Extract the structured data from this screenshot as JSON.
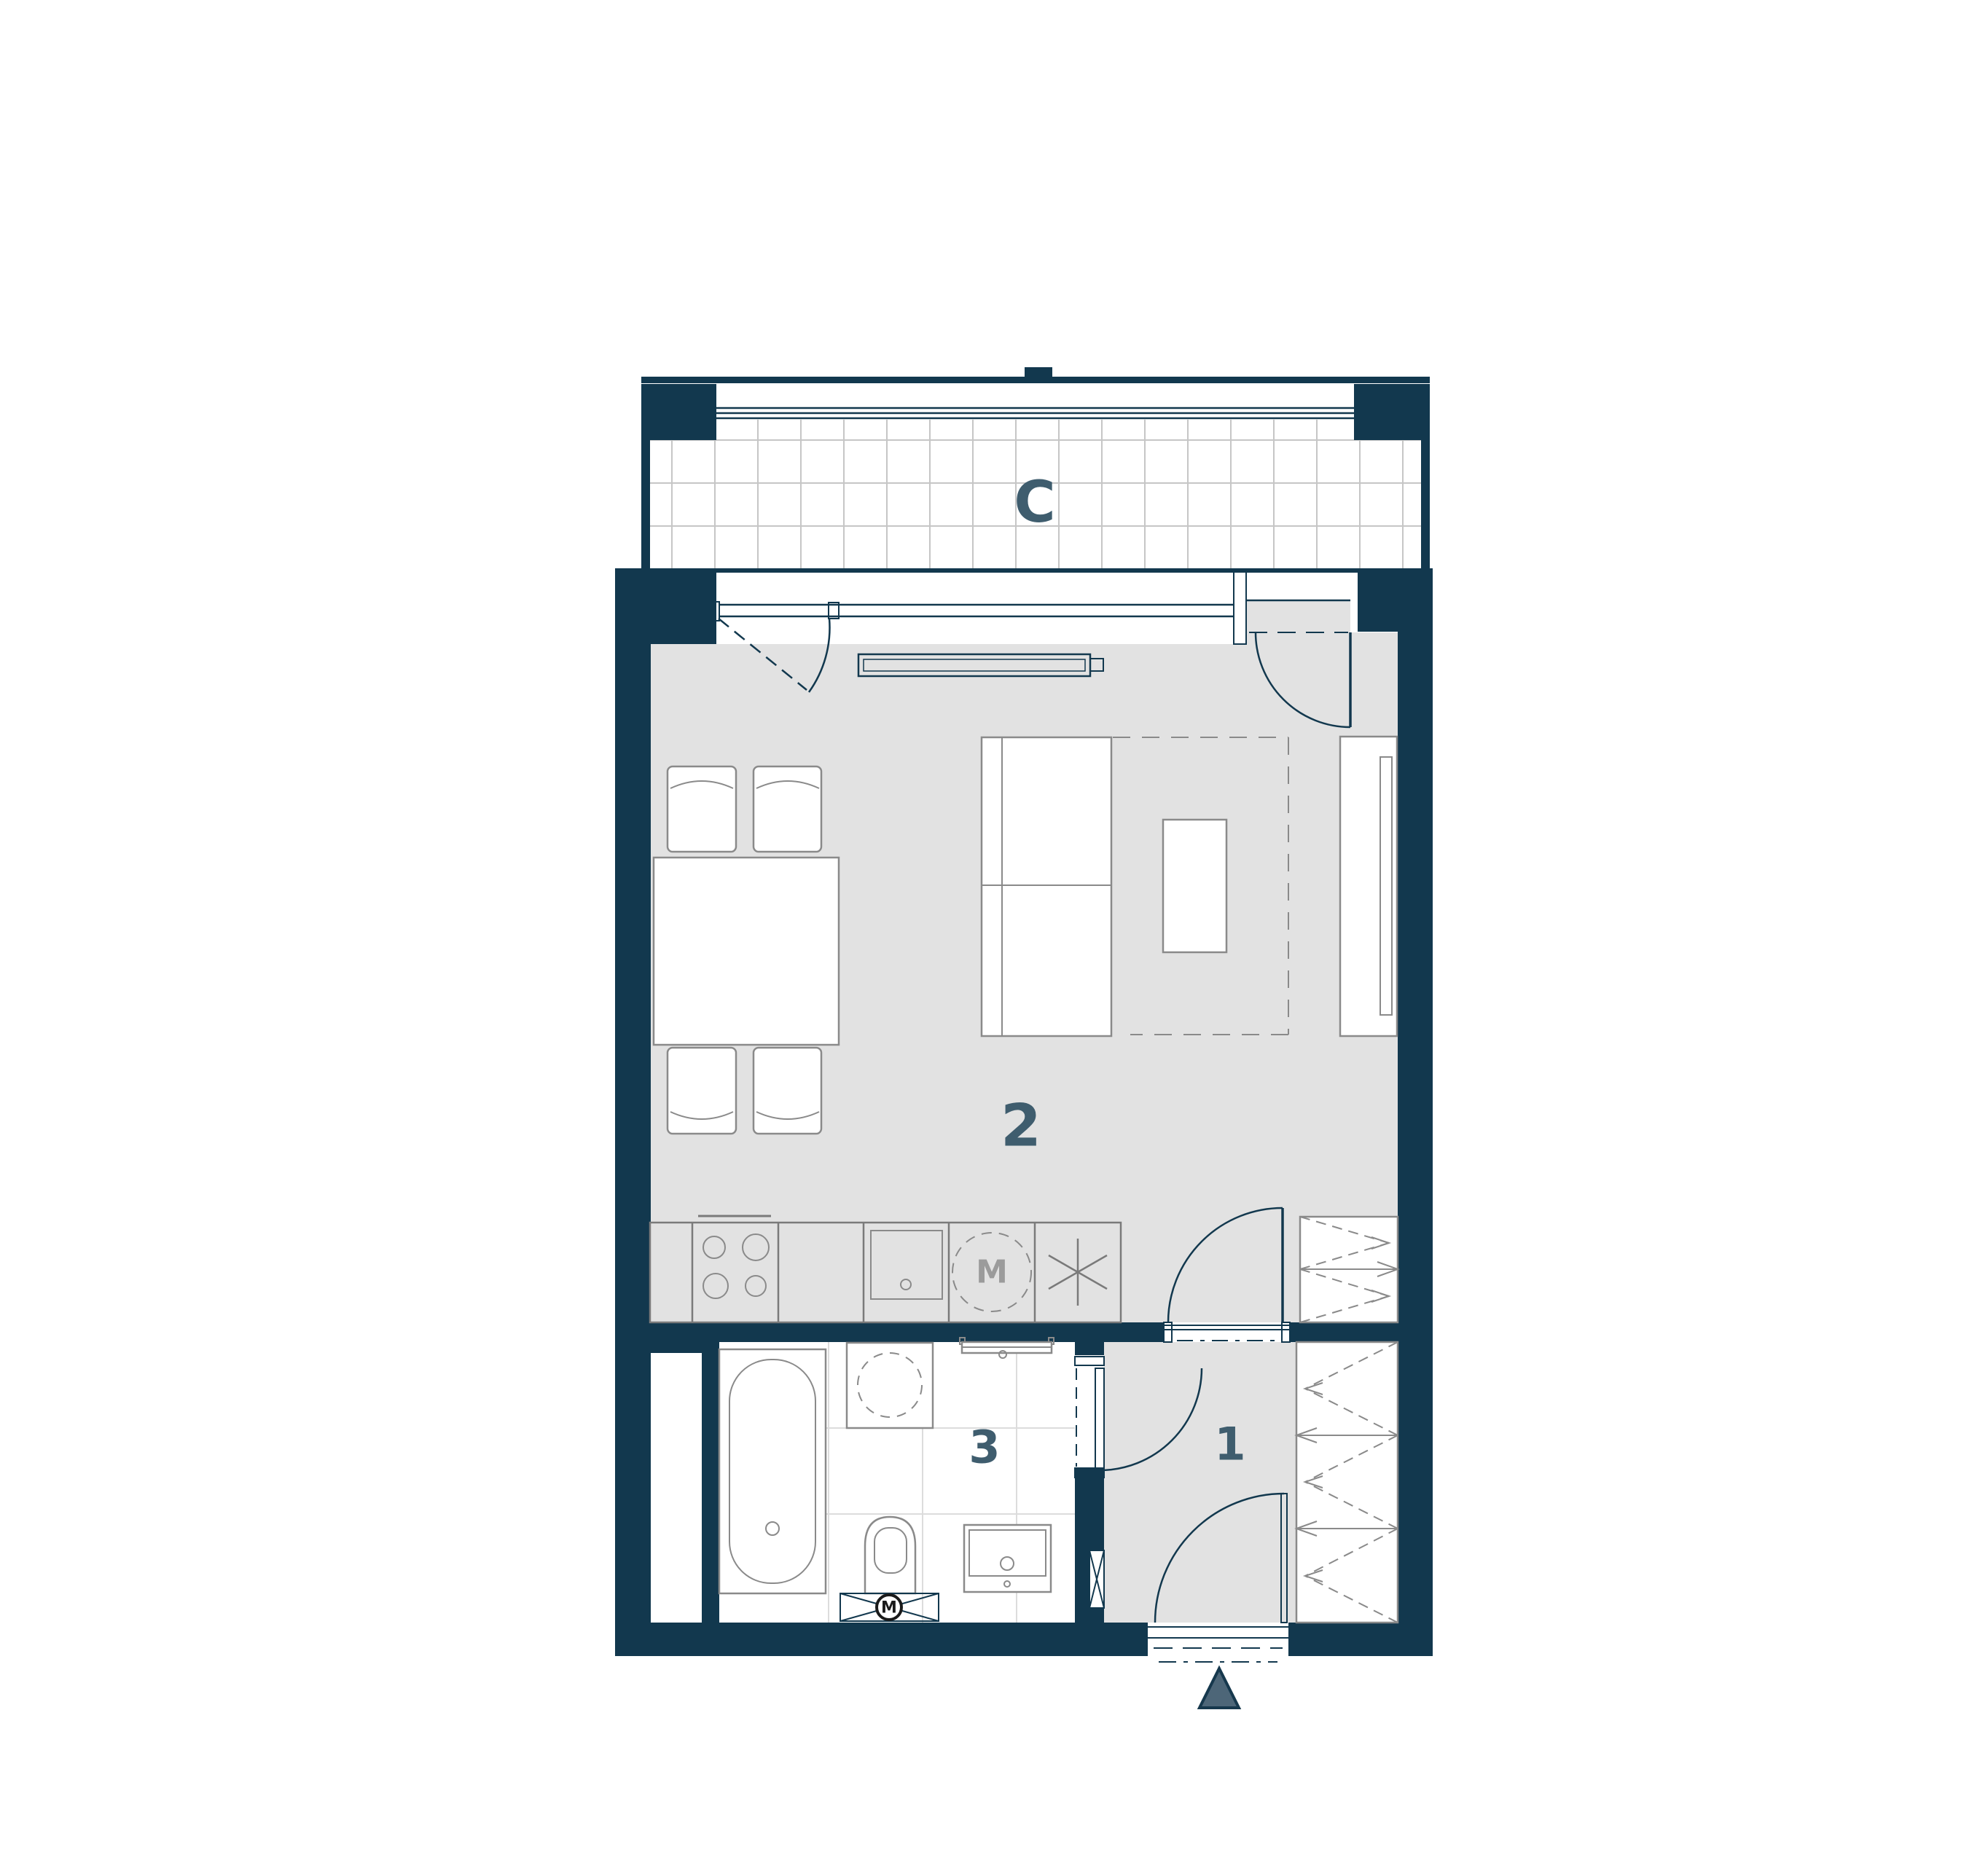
{
  "plan": {
    "type": "apartment-floor-plan",
    "rooms": {
      "balcony": {
        "label": "C"
      },
      "living_kitchen": {
        "label": "2"
      },
      "bathroom": {
        "label": "3"
      },
      "hall": {
        "label": "1"
      }
    },
    "appliances": {
      "washing_machine_label": "M",
      "extract_fan_label": "M"
    },
    "icons": [
      "entrance-arrow-icon",
      "door-swing-icon",
      "window-icon",
      "radiator-icon",
      "dining-table-icon",
      "chair-icon",
      "bed-icon",
      "coffee-table-icon",
      "wardrobe-icon",
      "tall-cabinet-icon",
      "hob-icon",
      "kitchen-sink-icon",
      "washing-machine-icon",
      "dishwasher-asterisk-icon",
      "bathtub-icon",
      "toilet-icon",
      "vanity-sink-icon",
      "towel-radiator-icon",
      "ventilation-fan-icon",
      "duct-shaft-icon"
    ],
    "colors": {
      "wall": "#12384e",
      "floor_gray": "#e2e2e2",
      "room_label": "#3f5d6e",
      "furniture_outline": "#8a8a8a",
      "bathroom_tile_line": "#dcdcdc",
      "balcony_grid_line": "#c6c6c6",
      "entrance_arrow_fill": "#4d6678"
    }
  }
}
